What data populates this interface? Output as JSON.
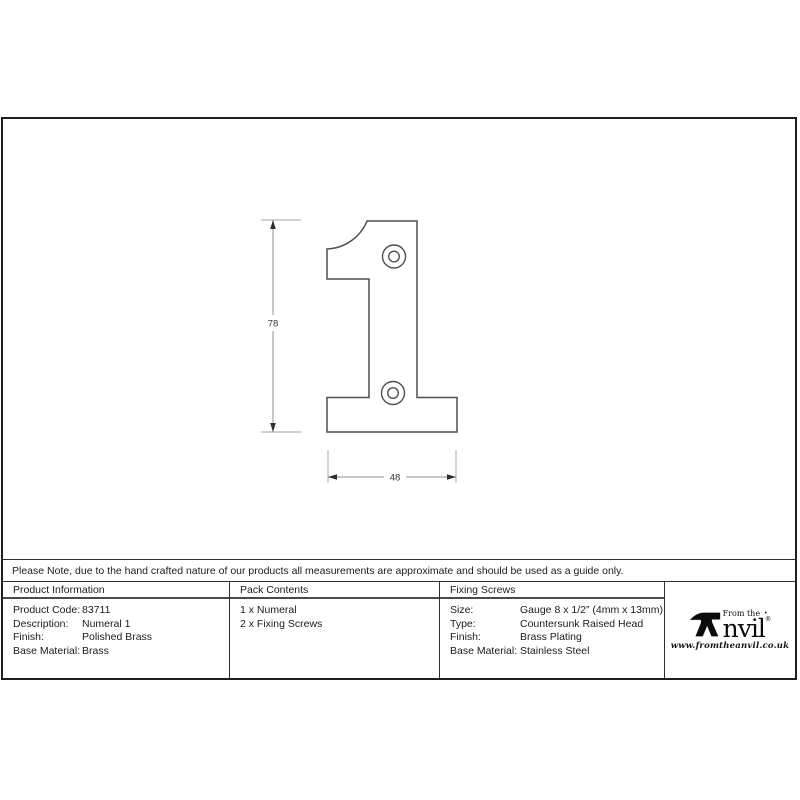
{
  "drawing": {
    "height_dimension_label": "78",
    "width_dimension_label": "48",
    "subject": "Numeral 1 technical outline with two screw holes"
  },
  "note": "Please Note, due to the hand crafted nature of our products all measurements are approximate and should be used as a guide only.",
  "table": {
    "product_information": {
      "header": "Product Information",
      "rows": [
        {
          "label": "Product Code:",
          "value": "83711"
        },
        {
          "label": "Description:",
          "value": "Numeral 1"
        },
        {
          "label": "Finish:",
          "value": "Polished Brass"
        },
        {
          "label": "Base Material:",
          "value": "Brass"
        }
      ]
    },
    "pack_contents": {
      "header": "Pack Contents",
      "items": [
        "1 x Numeral",
        "2 x Fixing Screws"
      ]
    },
    "fixing_screws": {
      "header": "Fixing Screws",
      "rows": [
        {
          "label": "Size:",
          "value": "Gauge 8 x 1/2” (4mm x 13mm)"
        },
        {
          "label": "Type:",
          "value": "Countersunk Raised Head"
        },
        {
          "label": "Finish:",
          "value": "Brass Plating"
        },
        {
          "label": "Base Material:",
          "value": "Stainless Steel"
        }
      ]
    }
  },
  "logo": {
    "prefix": "From the",
    "dot": "·",
    "name_rest": "nvil",
    "registered": "®",
    "url": "www.fromtheanvil.co.uk"
  },
  "colors": {
    "frame_border": "#1e1e1e",
    "table_border": "#2e2e2e",
    "outline": "#4f4f4f",
    "dimension_line": "#8f8f8f",
    "extension_line": "#b8b8b8",
    "text": "#1c1c1c"
  }
}
